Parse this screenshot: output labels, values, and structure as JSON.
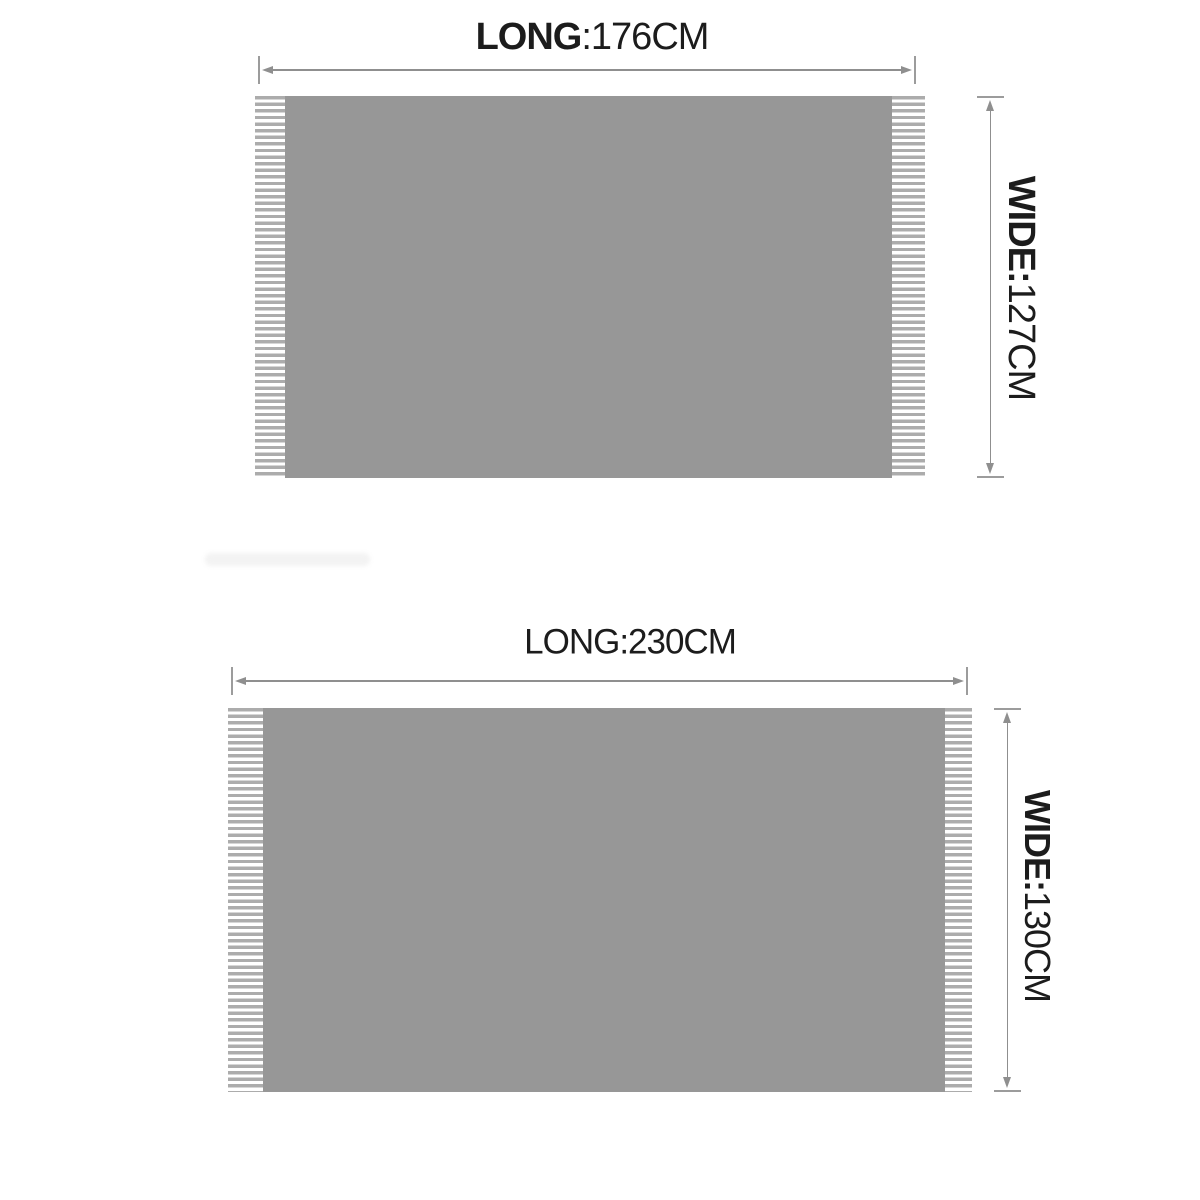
{
  "page": {
    "background": "#ffffff"
  },
  "colors": {
    "blanket_fill": "#979797",
    "fringe_stripe": "#acacac",
    "dimension_line": "#8f8f8f",
    "tick_mark": "#9c9c9c",
    "label_text": "#1c1c1c"
  },
  "diagrams": [
    {
      "id": "top-blanket-176x127",
      "long_label": {
        "strong": "LONG",
        "normal": ":176CM"
      },
      "wide_label": {
        "strong": "WIDE:",
        "normal": "127CM"
      }
    },
    {
      "id": "bottom-blanket-230x130",
      "long_label": {
        "strong": "",
        "normal": "LONG:230CM"
      },
      "wide_label": {
        "strong": "WIDE:",
        "normal": "130CM"
      }
    }
  ]
}
